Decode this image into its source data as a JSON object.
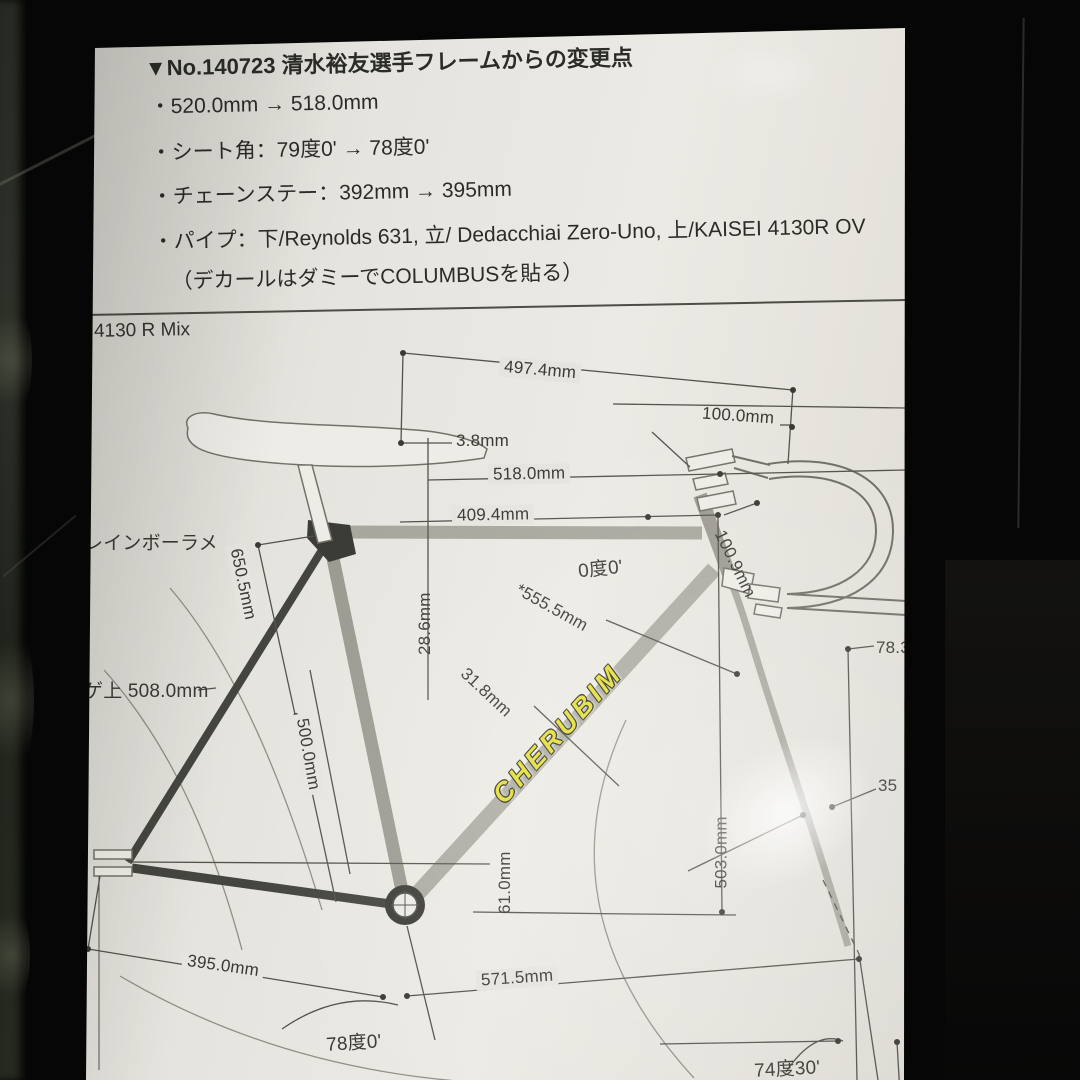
{
  "notes": {
    "heading": "▼No.140723 清水裕友選手フレームからの変更点",
    "items": [
      "・520.0mm → 518.0mm",
      "・シート角：79度0' → 78度0'",
      "・チェーンステー：392mm → 395mm",
      "・パイプ：下/Reynolds 631, 立/ Dedacchiai Zero-Uno, 上/KAISEI 4130R OV",
      "（デカールはダミーでCOLUMBUSを貼る）"
    ]
  },
  "drawing": {
    "series_label": "4130 R Mix",
    "paint_label": "レインボーラメ",
    "standover_label": "ゲ上 508.0mm",
    "logo": "CHERUBIM",
    "dims": {
      "saddle_bar_run": "497.4mm",
      "stem_length": "100.0mm",
      "saddle_setback": "3.8mm",
      "top_tube": "518.0mm",
      "reach": "409.4mm",
      "top_tube_angle": "0度0'",
      "seat_to_front": "*555.5mm",
      "seatpost_dia": "28.6mm",
      "downtube_dia": "31.8mm",
      "seat_tube_full": "650.5mm",
      "seat_tube_cc": "500.0mm",
      "head_extension": "100.9mm",
      "trail": "78.3",
      "fork_rake": "35",
      "front_height": "503.0mm",
      "bb_drop": "61.0mm",
      "chainstay": "395.0mm",
      "front_center": "571.5mm",
      "seat_angle": "78度0'",
      "head_angle": "74度30'"
    }
  },
  "colors": {
    "paper": "#e6e4de",
    "ink": "#2b2b28",
    "dim_line": "#54524c",
    "tube_light": "#a8a79e",
    "tube_dark": "#45453f",
    "logo_yellow": "#e3dd35",
    "background": "#060606"
  }
}
